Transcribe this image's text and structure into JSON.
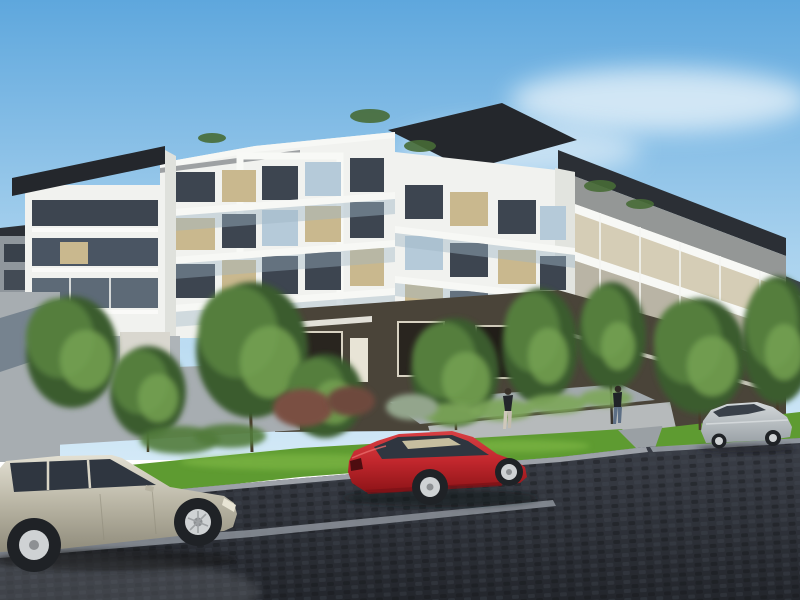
{
  "image": {
    "kind": "architectural-render-photo",
    "width_px": 800,
    "height_px": 600,
    "description": "Daytime artist's render of a modern low-rise apartment complex with white balconied facades, dark roof caps and a dark brick podium, fronted by young trees, a bright grass verge, a light concrete walkway with two pedestrians, and a dark paved street with three parked cars"
  },
  "scene": {
    "objects": [
      {
        "name": "sky",
        "label": "clear blue sky with soft clouds"
      },
      {
        "name": "building-left-tower",
        "label": "left apartment tower with dark flat roof overhang and glass balconies"
      },
      {
        "name": "building-center-block",
        "label": "central white apartment block with boxed balcony frames"
      },
      {
        "name": "building-midright-block",
        "label": "mid-right apartment block with dark sloped roof cap"
      },
      {
        "name": "building-right-wing",
        "label": "right wing receding into distance with horizontal balcony bands"
      },
      {
        "name": "ground-podium",
        "label": "dark brick ground-floor podium with windows and entry"
      },
      {
        "name": "boundary-walls",
        "label": "grey rendered boundary and planter walls"
      },
      {
        "name": "landscaping",
        "label": "young green trees, hedges and russet shrubs along the frontage"
      },
      {
        "name": "grass-verge",
        "label": "bright green grass verge between footpath and kerb"
      },
      {
        "name": "walkway",
        "label": "light concrete pedestrian walkway"
      },
      {
        "name": "street",
        "label": "dark charcoal paved street with light gutter strip"
      },
      {
        "name": "car-silver-wagon",
        "label": "champagne-silver station wagon parked at left, facing right"
      },
      {
        "name": "car-red-coupe",
        "label": "red coupe parked mid-frame, seen from rear three-quarter"
      },
      {
        "name": "car-silver-sedan",
        "label": "silver sedan parked in the distance at right"
      },
      {
        "name": "pedestrian-1",
        "label": "pedestrian in dark top and light trousers"
      },
      {
        "name": "pedestrian-2",
        "label": "pedestrian in dark top and blue jeans"
      }
    ]
  },
  "palette": {
    "sky_top": "#5ea7dd",
    "sky_mid": "#a9d2ee",
    "sky_horizon": "#d3e9f7",
    "cloud": "#eef6fb",
    "roof_dark": "#2b2f35",
    "roof_black": "#24272c",
    "facade_white": "#f1f2ef",
    "facade_shadow": "#dfe1dc",
    "facade_cream": "#e9e6da",
    "parapet": "#f7f8f5",
    "glass_dark": "#3d4550",
    "glass_warm": "#c9b88e",
    "glass_blue": "#b5cad9",
    "podium_dark": "#4a4439",
    "podium_window": "#29251f",
    "wall_grey": "#a7adb1",
    "wall_blue_grey": "#76838f",
    "planter_grey": "#a2a9ad",
    "tree_dark": "#3a5c2d",
    "tree_mid": "#547e3c",
    "tree_light": "#76a152",
    "hedge_green": "#7da65a",
    "shrub_red": "#7a5042",
    "shrub_rust": "#6e483c",
    "bush_sage": "#93a58c",
    "trunk_brown": "#4a3a2c",
    "grass_green": "#5e9b31",
    "grass_light": "#85bd4a",
    "path_grey": "#b6babb",
    "road_top": "#3b3f48",
    "road_bottom": "#23262c",
    "kerb_grey": "#a8adb4",
    "gutter_bright": "#8d939b",
    "car_silver": "#b5b1a0",
    "car_red": "#c1272d",
    "car_grey_sedan": "#b7bcc0",
    "car_glass": "#2f3640",
    "wheel_dark": "#1f2226",
    "alloy_silver": "#cfd2d4",
    "ped_top_dark": "#23262b",
    "ped_legs_light": "#cfc8bb",
    "ped_jeans_blue": "#5d6f85"
  }
}
